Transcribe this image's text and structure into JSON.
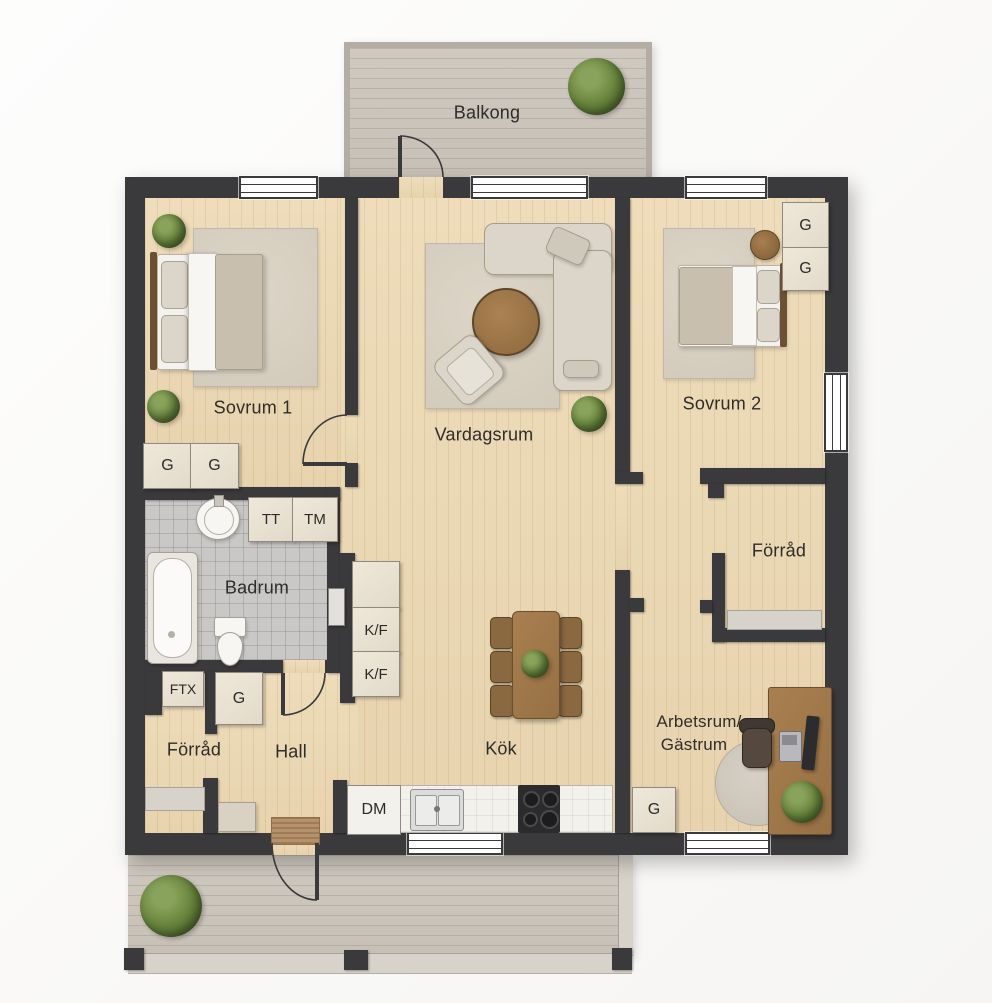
{
  "rooms": {
    "balkong": {
      "label": "Balkong"
    },
    "sovrum1": {
      "label": "Sovrum 1"
    },
    "vardagsrum": {
      "label": "Vardagsrum"
    },
    "sovrum2": {
      "label": "Sovrum 2"
    },
    "badrum": {
      "label": "Badrum"
    },
    "forrad_right": {
      "label": "Förråd"
    },
    "forrad_left": {
      "label": "Förråd"
    },
    "hall": {
      "label": "Hall"
    },
    "kok": {
      "label": "Kök"
    },
    "arbetsrum_gastrum": {
      "label_line1": "Arbetsrum/",
      "label_line2": "Gästrum"
    }
  },
  "fixtures": {
    "wardrobe": "G",
    "tumble_dryer": "TT",
    "washing_machine": "TM",
    "fridge_freezer": "K/F",
    "dishwasher": "DM",
    "ventilation_unit": "FTX"
  },
  "colors": {
    "wall": "#3a393b",
    "floor_wood": "#ead8b6",
    "deck": "#ccc6bc",
    "bathroom_tile": "#c9c8c6",
    "furniture_beige": "#dcd6ca",
    "wood_brown": "#9c7748",
    "plant_green": "#64803a"
  }
}
